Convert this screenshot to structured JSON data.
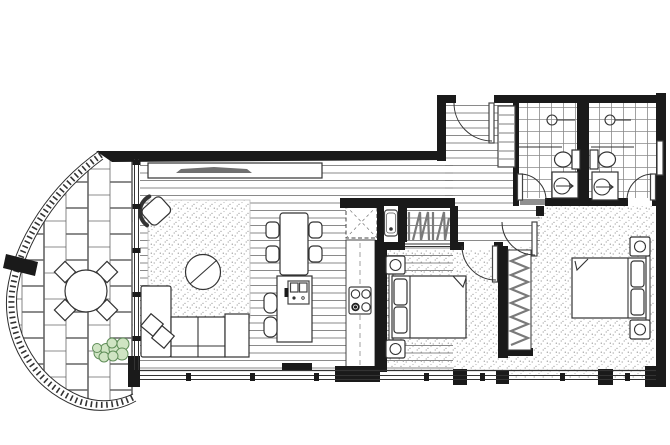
{
  "canvas": {
    "width": 670,
    "height": 445,
    "background": "#ffffff"
  },
  "palette": {
    "paper": "#ffffff",
    "wall": "#1a1a1a",
    "line_dark": "#2e2e2e",
    "board_line": "#7d7d7d",
    "tile_line": "#8a8a8a",
    "brick_line": "#666666",
    "stipple_dot": "#9a9a9a",
    "threshold": "#8f8f8f",
    "tv": "#707070",
    "glass": "#333333",
    "plant_fill": "#cfe4c3",
    "plant_stroke": "#5f8d58"
  },
  "drawing": {
    "kind": "apartment-floor-plan",
    "rooms": [
      "balcony",
      "living-room",
      "dining-area",
      "kitchen",
      "entry-hall",
      "hallway",
      "bathroom-1",
      "bathroom-2",
      "bedroom-1",
      "bedroom-2",
      "laundry-nook",
      "linen-closet",
      "wardrobe-1",
      "wardrobe-2"
    ],
    "floor_textures": {
      "balcony": "brick-paving",
      "living-kitchen-entry": "timber-boards",
      "bathrooms": "square-tiles",
      "bedrooms": "stipple-carpet",
      "living-rug": "stipple-rug"
    },
    "furniture_icons": [
      "outdoor-round-table-icon",
      "outdoor-chair-icon",
      "shrub-icon",
      "tv-unit-icon",
      "tv-icon",
      "armchair-icon",
      "round-coffee-table-icon",
      "modular-sofa-icon",
      "cushion-icon",
      "dining-table-icon",
      "dining-chair-icon",
      "kitchen-island-icon",
      "sink-icon",
      "bar-stool-icon",
      "cooktop-icon",
      "fridge-space-icon",
      "laundry-tub-icon",
      "double-bed-icon",
      "pillow-icon",
      "bedside-table-icon",
      "lamp-icon",
      "hanging-clothes-icon",
      "toilet-icon",
      "vanity-basin-icon",
      "shower-rose-icon",
      "door-swing-icon",
      "window-mullion-icon",
      "balustrade-icon",
      "linen-shelves-icon"
    ],
    "door_count": 6,
    "window_walls": [
      "south-glazing",
      "balcony-glazing"
    ]
  }
}
